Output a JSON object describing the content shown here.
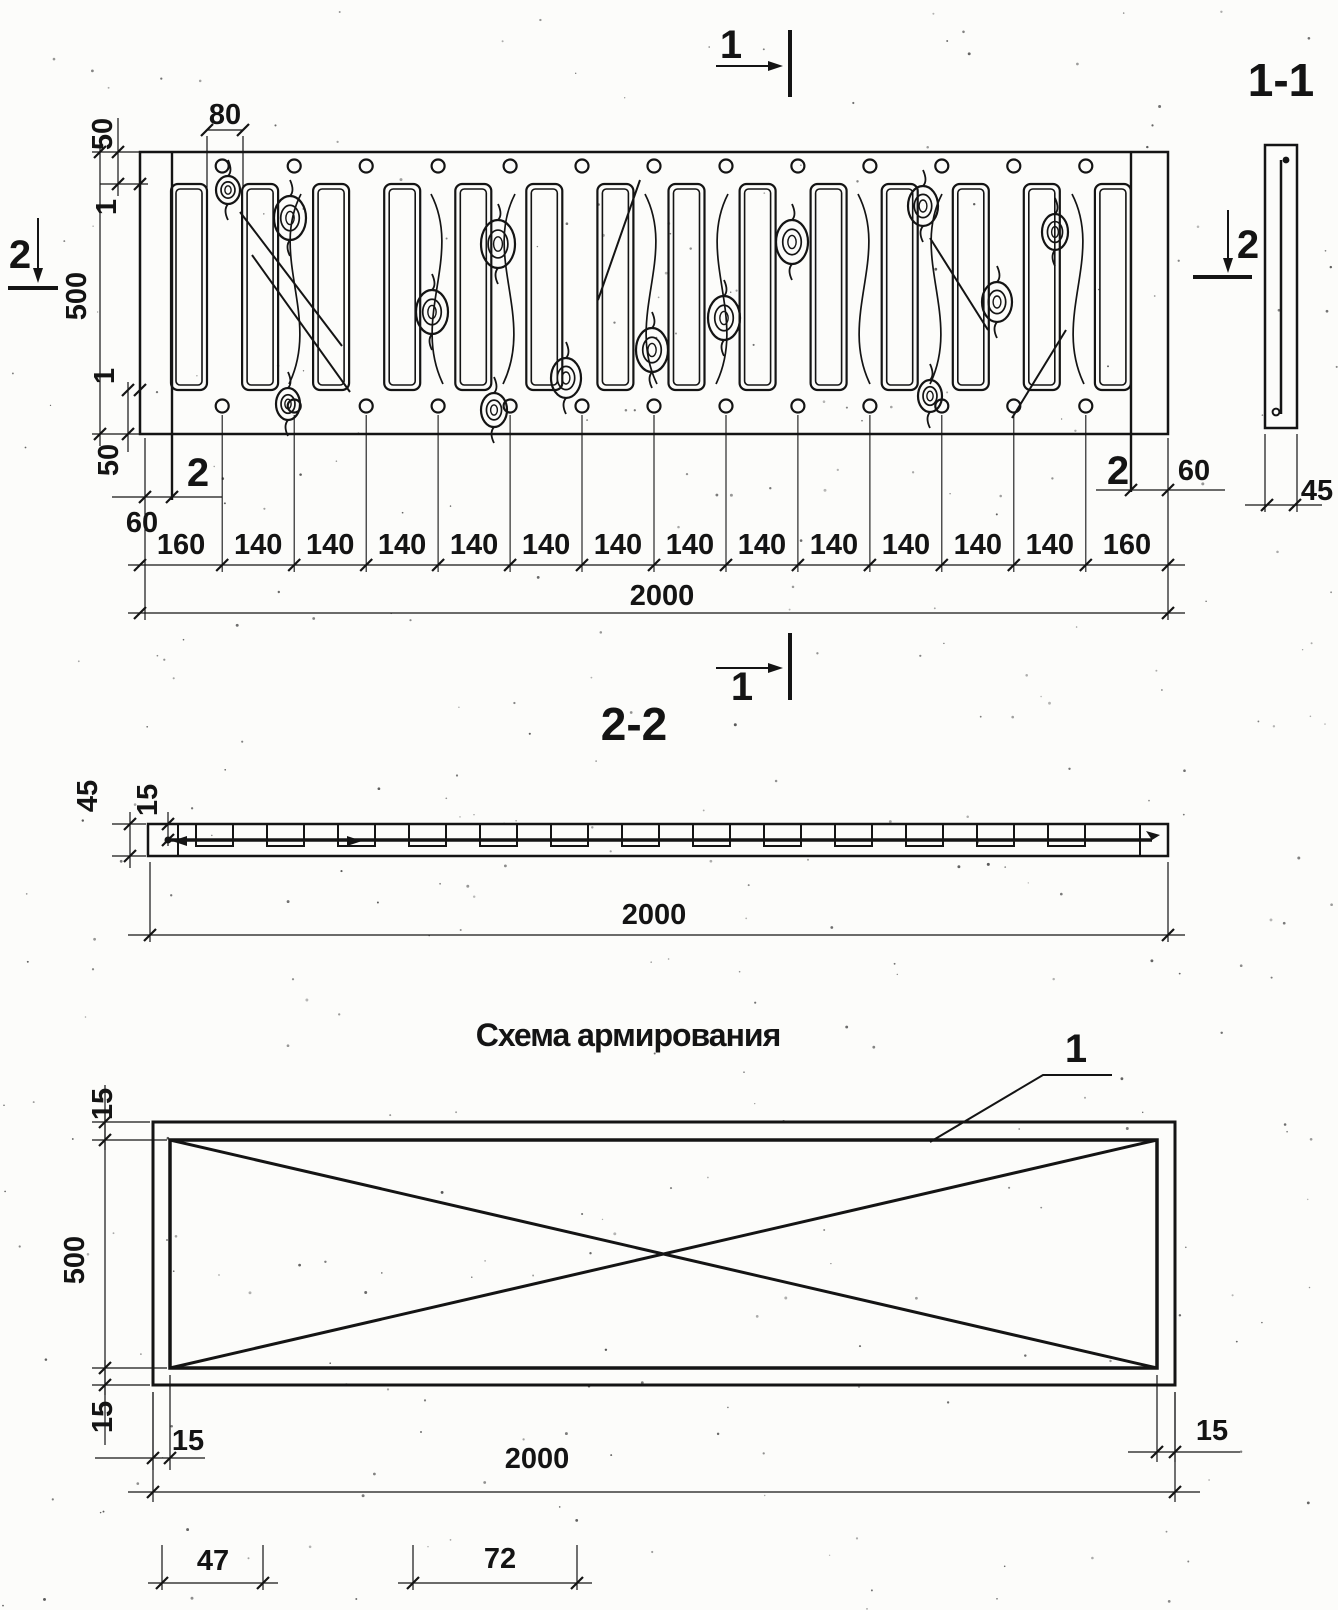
{
  "drawing": {
    "plan": {
      "section_marker_top": "1",
      "section_marker_bottom": "1",
      "cut2_marker_left": "2",
      "cut2_marker_right": "2",
      "dim_board_width": "80",
      "dim_edge_top": "50",
      "dim_gap_top": "1",
      "dim_height": "500",
      "dim_gap_bottom": "1",
      "dim_edge_bottom": "50",
      "bar_pos_left": "2",
      "bar_pos_right": "2",
      "dim_bar_offset_left": "60",
      "dim_bar_offset_right": "60",
      "chain_dims": [
        "160",
        "140",
        "140",
        "140",
        "140",
        "140",
        "140",
        "140",
        "140",
        "140",
        "140",
        "140",
        "140",
        "160"
      ],
      "dim_total": "2000",
      "slot_count": 14,
      "nail_count_per_row": 13
    },
    "section_1_1": {
      "title": "1-1",
      "dim_thickness": "45"
    },
    "section_2_2": {
      "title": "2-2",
      "dim_thickness": "45",
      "dim_bar_depth": "15",
      "dim_total": "2000"
    },
    "scheme": {
      "title": "Схема армирования",
      "bar_pos_label": "1",
      "dim_offset_top": "15",
      "dim_height": "500",
      "dim_offset_bottom": "15",
      "dim_offset_left": "15",
      "dim_offset_right": "15",
      "dim_total": "2000",
      "dim_47": "47",
      "dim_72": "72"
    }
  }
}
